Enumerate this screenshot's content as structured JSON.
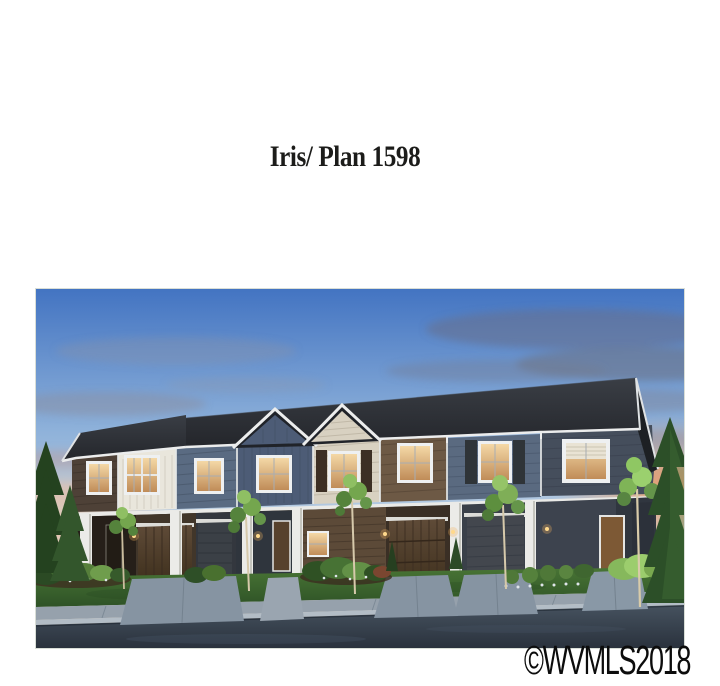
{
  "page": {
    "title": "Iris/ Plan 1598",
    "watermark": "©WVMLS2018"
  },
  "photo": {
    "description": "Dusk architectural rendering of a row of two-story townhomes with siding sections in dark brown, white board-and-batten, slate blue, cream and dark gray, two front gables, warmly lit windows, attached garages with wood and gray doors, white porch columns, landscaped beds, ornamental and evergreen trees, a sidewalk and a dark street in the foreground under a blue sky with sunset clouds",
    "palette": {
      "sky_top": "#4374c2",
      "sky_mid": "#8fb2da",
      "sky_horizon": "#dcd6c8",
      "sunset_pink": "#e8bfa8",
      "sunset_orange": "#e2956a",
      "cloud_gray": "#6d7588",
      "roof_dark": "#24262b",
      "trim_white": "#eceded",
      "siding_white": "#e9e6dc",
      "siding_slate": "#5a6b82",
      "siding_blue": "#4d5c76",
      "siding_cream": "#d8d1c1",
      "siding_brown": "#6d5945",
      "siding_darkslate": "#454e5c",
      "base_brown": "#362d23",
      "garage_wood": "#5f4b38",
      "garage_gray": "#43474e",
      "door_brown": "#7d5935",
      "window_glow": "#eecf9c",
      "lawn_green": "#497535",
      "shrub_green": "#2f5124",
      "tree_lit_green": "#8fbf63",
      "evergreen": "#2c4f28",
      "concrete": "#96a1ac",
      "driveway": "#8694a2",
      "curb_light": "#b3bdc6",
      "street_asphalt": "#39434f"
    }
  }
}
